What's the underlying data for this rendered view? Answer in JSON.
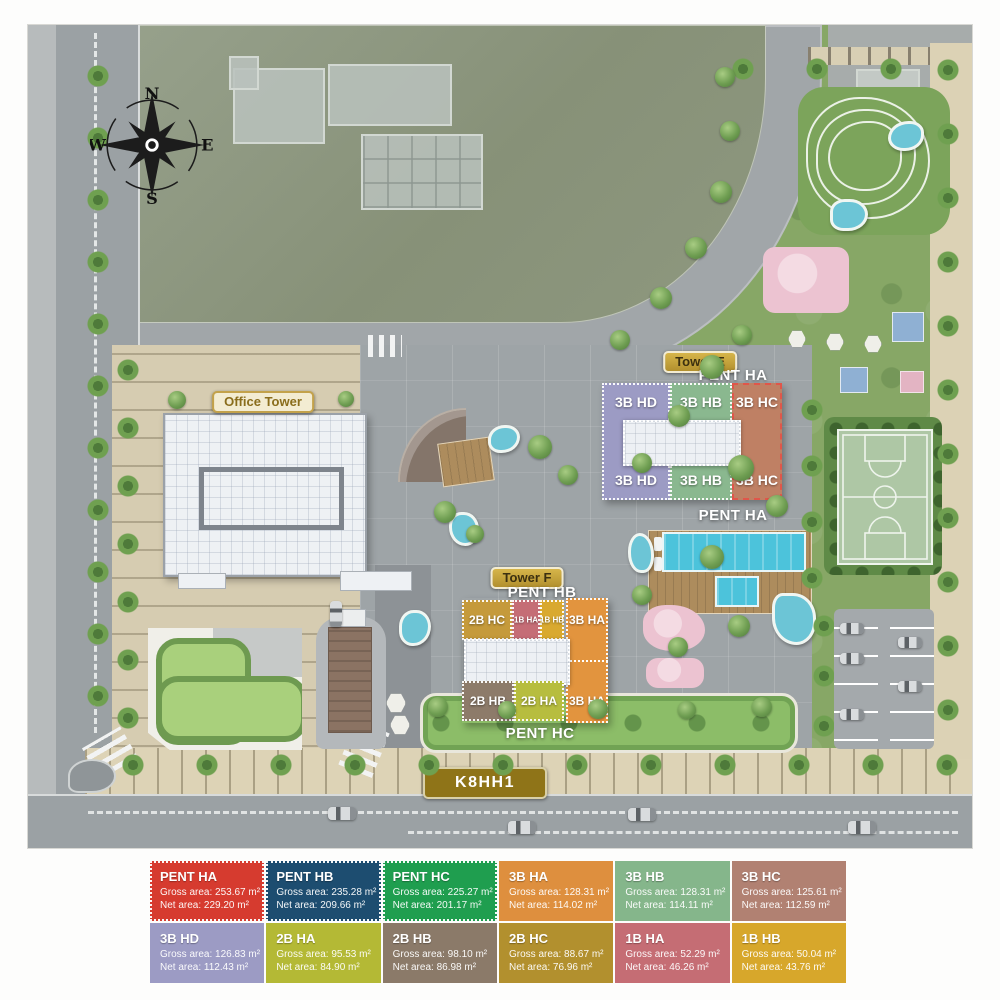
{
  "compass": {
    "north": "N",
    "east": "E",
    "south": "S",
    "west": "W"
  },
  "badges": {
    "office_tower": "Office Tower",
    "tower_e": "Tower E",
    "tower_f": "Tower F",
    "site_code": "K8HH1"
  },
  "tower_e": {
    "pent_top": "PENT HA",
    "pent_bottom": "PENT HA",
    "columns": [
      {
        "label": "3B HD",
        "color": "#9c9bc4"
      },
      {
        "label": "3B HB",
        "color": "#8ab88f"
      },
      {
        "label": "3B HC",
        "color": "#bf8064"
      }
    ]
  },
  "tower_f": {
    "pent_top": "PENT HB",
    "pent_bottom": "PENT HC",
    "top_cells": [
      {
        "label": "2B HC",
        "color": "#c59a3b"
      },
      {
        "label": "1B HA",
        "color": "#c56d76"
      },
      {
        "label": "1B HB",
        "color": "#d9a92f"
      }
    ],
    "bottom_cells": [
      {
        "label": "2B HB",
        "color": "#8d7b6a"
      },
      {
        "label": "2B HA",
        "color": "#b7bd3f"
      }
    ],
    "right_cell": {
      "label": "3B HA",
      "color": "#e2943e"
    }
  },
  "legend": {
    "rows": [
      [
        {
          "name": "PENT HA",
          "gross": "Gross area: 253.67 m²",
          "net": "Net area: 229.20 m²",
          "color": "#d63b2f"
        },
        {
          "name": "PENT HB",
          "gross": "Gross area: 235.28 m²",
          "net": "Net area: 209.66 m²",
          "color": "#1d4d70"
        },
        {
          "name": "PENT HC",
          "gross": "Gross area: 225.27 m²",
          "net": "Net area: 201.17 m²",
          "color": "#1f9e4f"
        },
        {
          "name": "3B HA",
          "gross": "Gross area: 128.31 m²",
          "net": "Net area: 114.02 m²",
          "color": "#de8f3e"
        },
        {
          "name": "3B HB",
          "gross": "Gross area: 128.31 m²",
          "net": "Net area: 114.11 m²",
          "color": "#85b68b"
        },
        {
          "name": "3B HC",
          "gross": "Gross area: 125.61 m²",
          "net": "Net area: 112.59 m²",
          "color": "#b18172"
        }
      ],
      [
        {
          "name": "3B HD",
          "gross": "Gross area: 126.83 m²",
          "net": "Net area: 112.43 m²",
          "color": "#9c9bc4"
        },
        {
          "name": "2B HA",
          "gross": "Gross area: 95.53 m²",
          "net": "Net area: 84.90 m²",
          "color": "#b4b935"
        },
        {
          "name": "2B HB",
          "gross": "Gross area: 98.10 m²",
          "net": "Net area: 86.98 m²",
          "color": "#8b7a69"
        },
        {
          "name": "2B HC",
          "gross": "Gross area: 88.67 m²",
          "net": "Net area: 76.96 m²",
          "color": "#b2902e"
        },
        {
          "name": "1B HA",
          "gross": "Gross area: 52.29 m²",
          "net": "Net area: 46.26 m²",
          "color": "#c56d74"
        },
        {
          "name": "1B HB",
          "gross": "Gross area: 50.04 m²",
          "net": "Net area: 43.76 m²",
          "color": "#d7a72b"
        }
      ]
    ]
  }
}
